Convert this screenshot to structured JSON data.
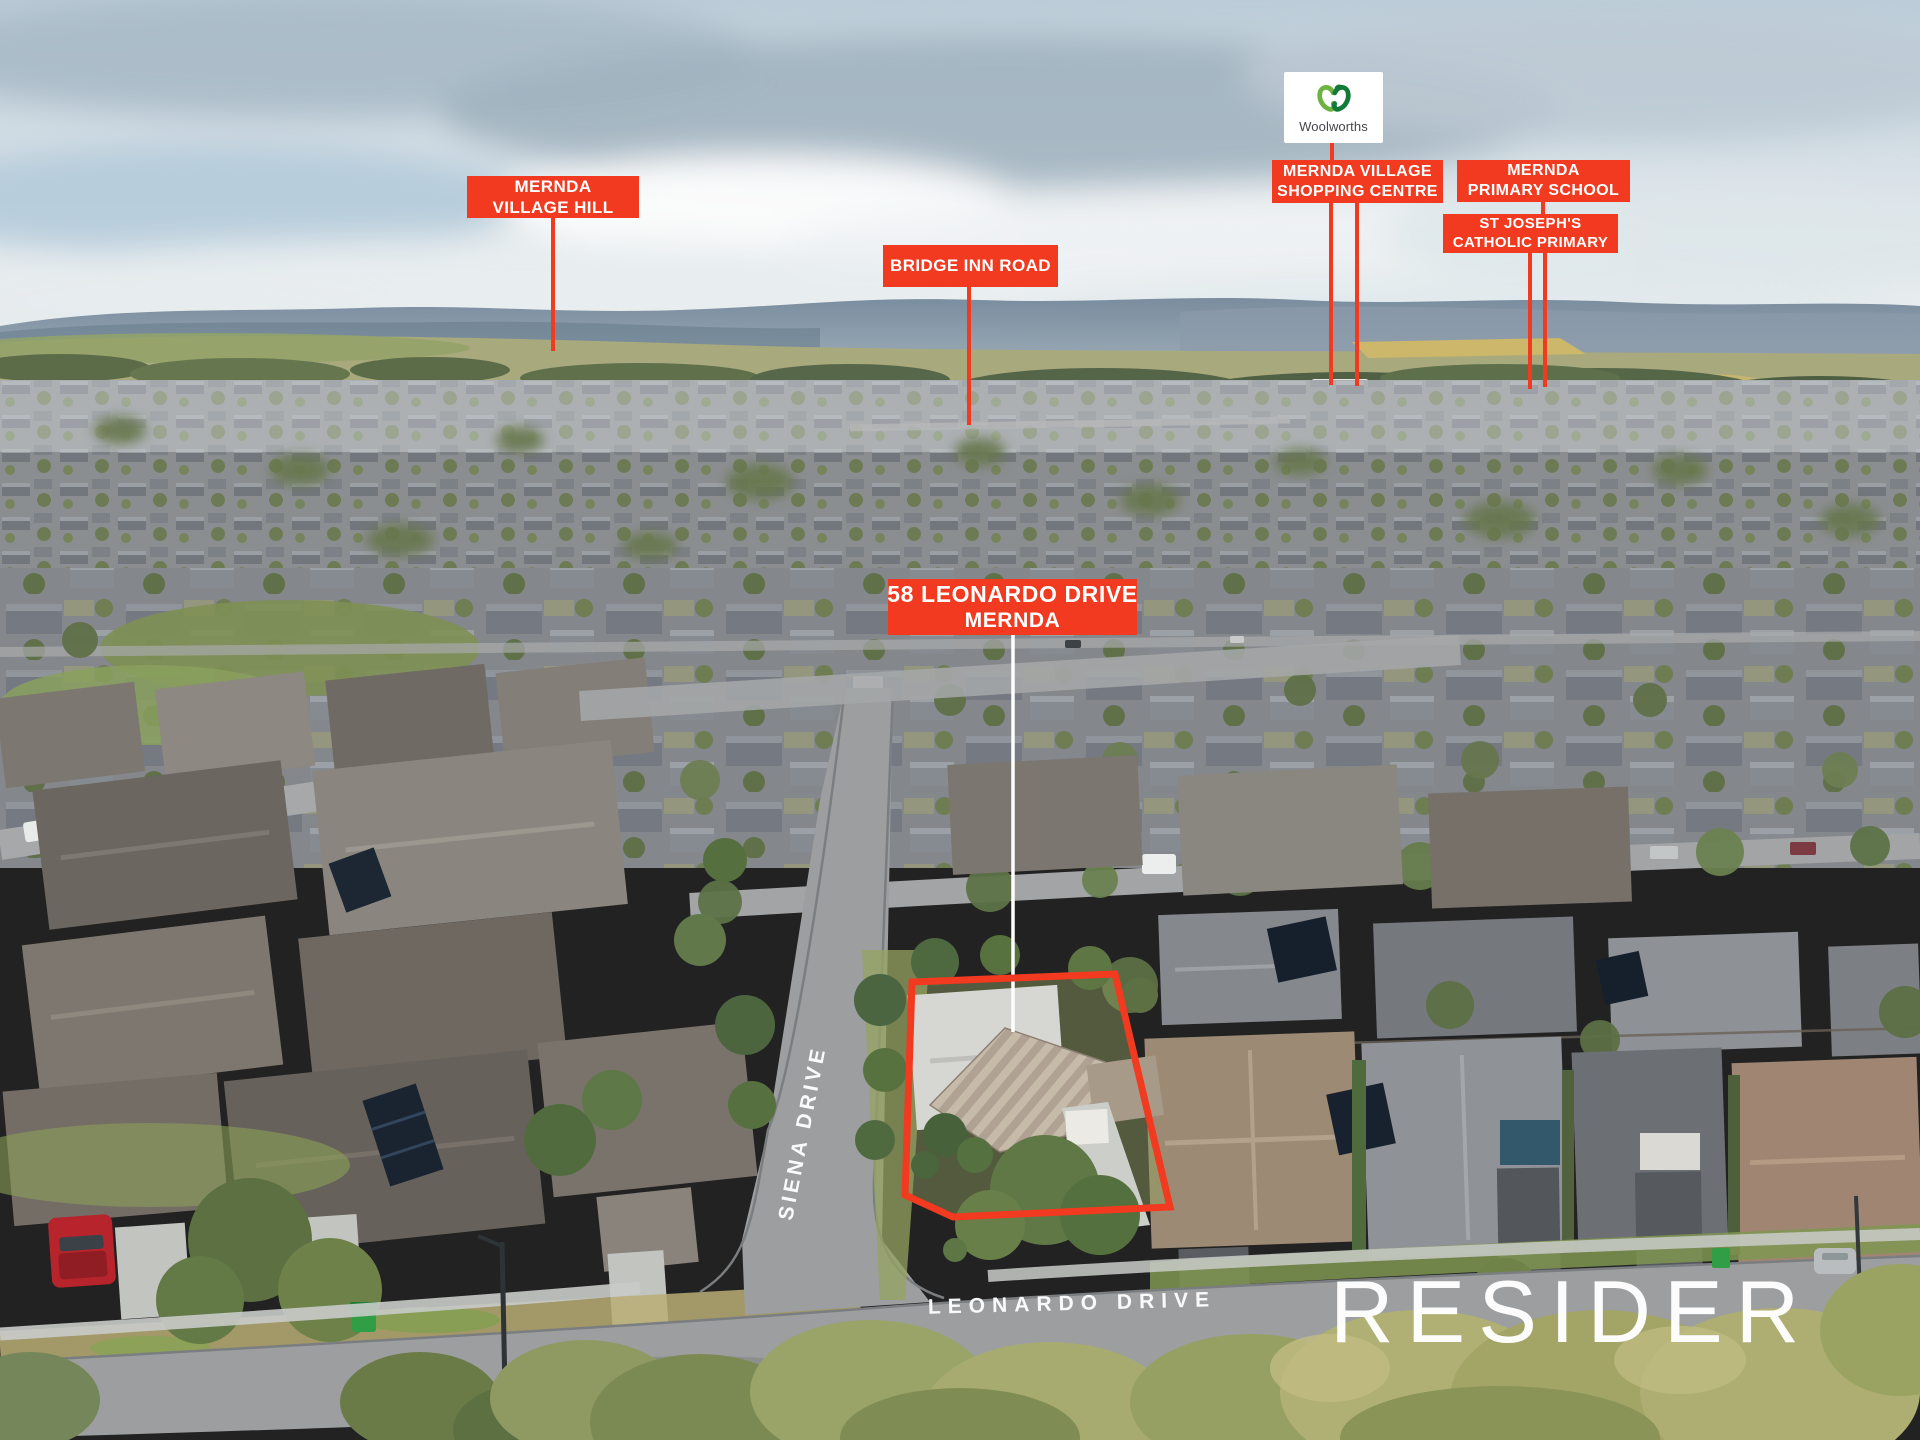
{
  "photo": {
    "description": "Aerial drone photograph of Mernda residential suburb with location callouts"
  },
  "callouts": {
    "village_hill": {
      "line1": "MERNDA",
      "line2": "VILLAGE HILL"
    },
    "bridge_inn_road": {
      "line1": "BRIDGE INN ROAD"
    },
    "shopping_centre": {
      "line1": "MERNDA VILLAGE",
      "line2": "SHOPPING CENTRE"
    },
    "primary_school": {
      "line1": "MERNDA",
      "line2": "PRIMARY SCHOOL"
    },
    "st_josephs": {
      "line1": "ST JOSEPH'S",
      "line2": "CATHOLIC PRIMARY"
    },
    "property": {
      "line1": "58 LEONARDO DRIVE",
      "line2": "MERNDA"
    }
  },
  "logos": {
    "woolworths": "Woolworths",
    "brand": "RESIDER"
  },
  "street_labels": {
    "siena": "SIENA DRIVE",
    "leonardo": "LEONARDO DRIVE"
  },
  "colors": {
    "callout_red": "#f13a20",
    "leader_white": "#ffffff",
    "property_outline_red": "#f13a20",
    "woolworths_green_light": "#6cb33f",
    "woolworths_green_dark": "#127a38"
  }
}
